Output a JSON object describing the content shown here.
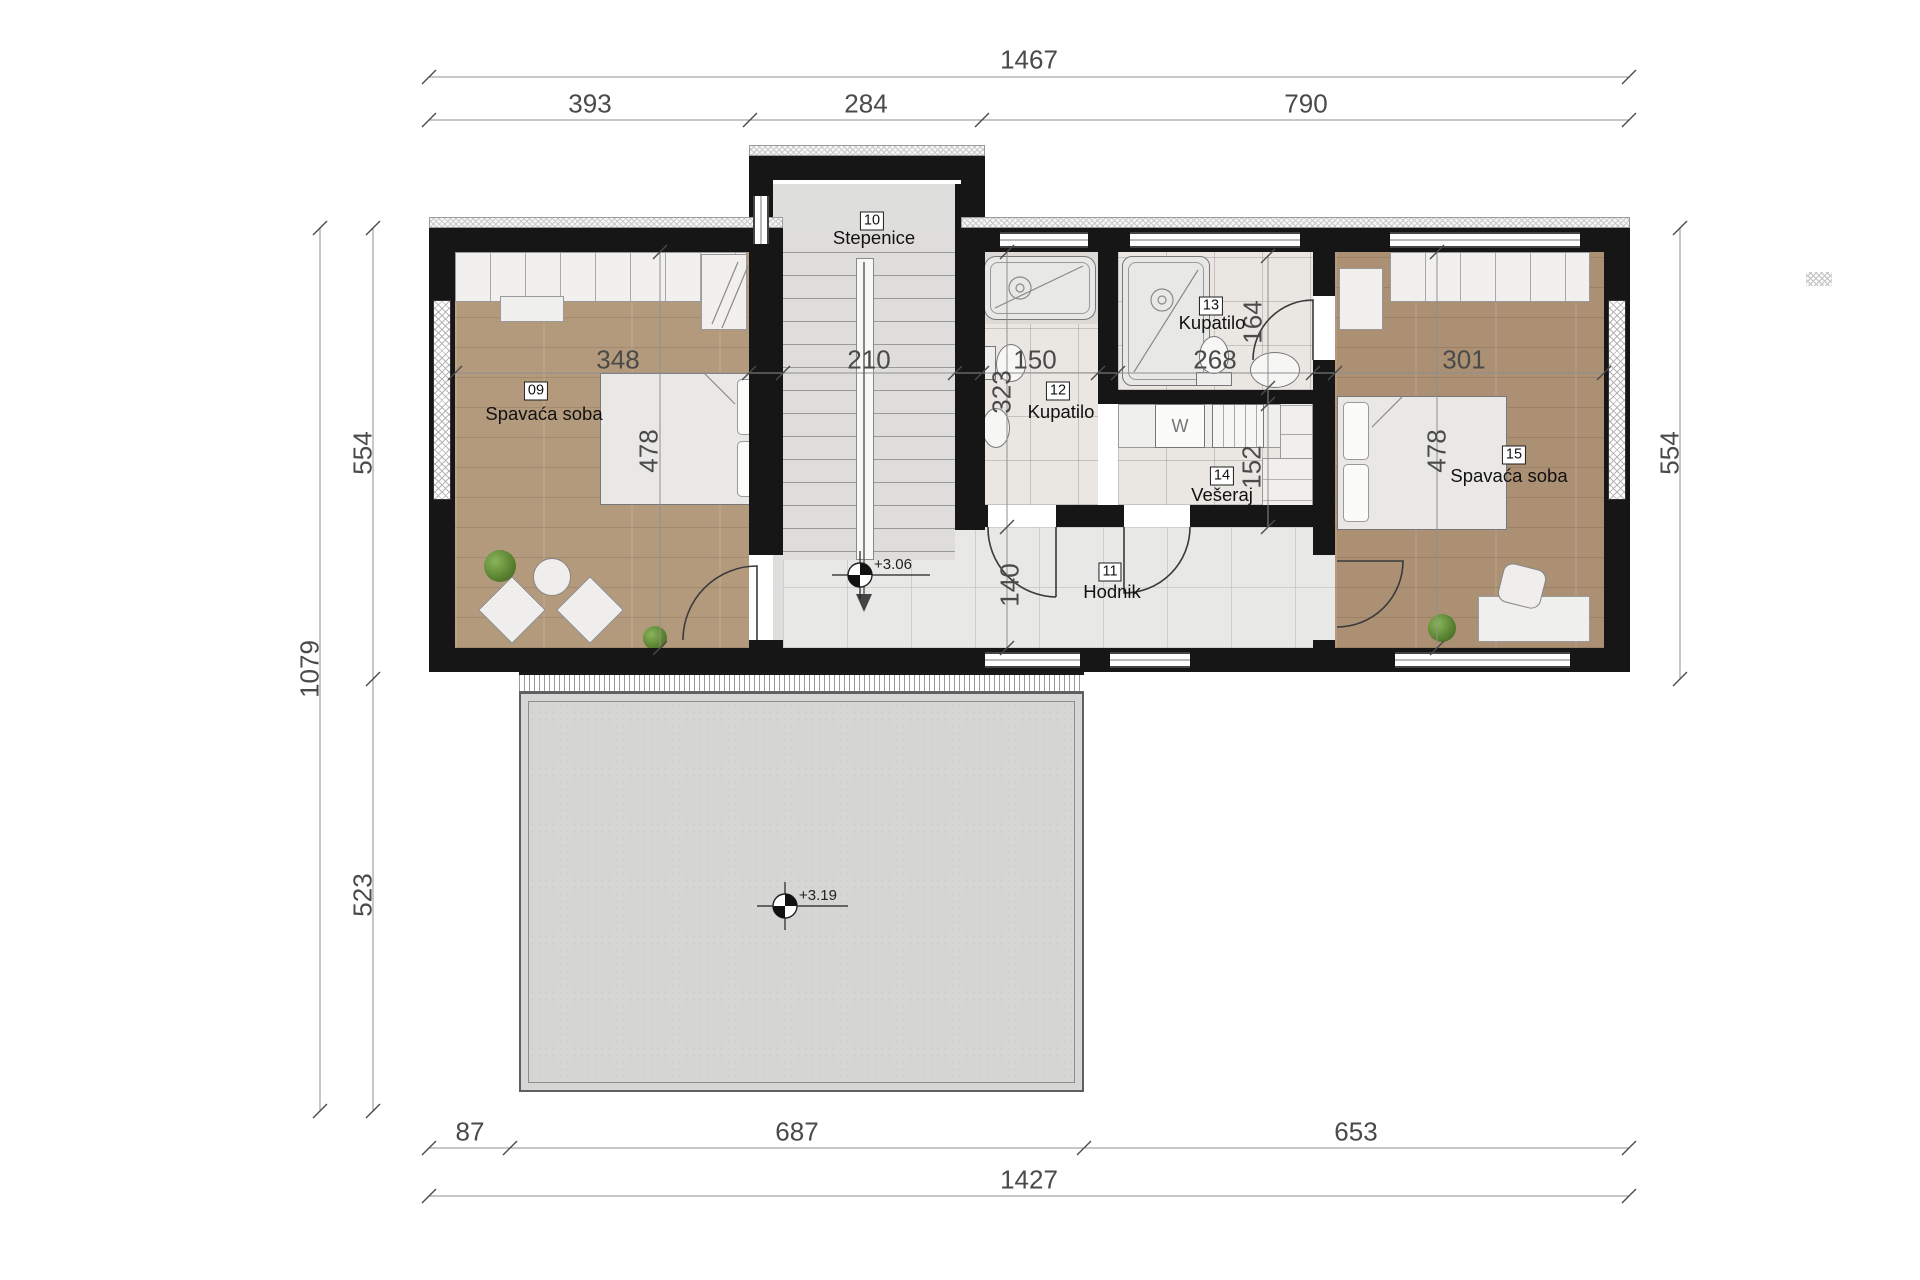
{
  "dims": {
    "top": {
      "total": "1467",
      "segs": [
        "393",
        "284",
        "790"
      ]
    },
    "bottom": {
      "segs": [
        "87",
        "687",
        "653"
      ],
      "total": "1427"
    },
    "left": {
      "total": "1079",
      "upper": "554",
      "lower": "523"
    },
    "right": {
      "upper": "554"
    },
    "inner": {
      "bed09_w": "348",
      "stairs_w": "210",
      "bath12_w": "150",
      "bath13_w": "268",
      "bed15_w": "301",
      "bed09_h": "478",
      "bed15_h": "478",
      "bath12_h": "323",
      "bath13_h": "164",
      "veseraj_h": "152",
      "hodnik_h": "140"
    }
  },
  "rooms": {
    "r09": {
      "num": "09",
      "name": "Spavaća soba"
    },
    "r10": {
      "num": "10",
      "name": "Stepenice"
    },
    "r11": {
      "num": "11",
      "name": "Hodnik"
    },
    "r12": {
      "num": "12",
      "name": "Kupatilo"
    },
    "r13": {
      "num": "13",
      "name": "Kupatilo"
    },
    "r14": {
      "num": "14",
      "name": "Vešeraj"
    },
    "r15": {
      "num": "15",
      "name": "Spavaća soba"
    }
  },
  "levels": {
    "upper": "+3.06",
    "terrace": "+3.19"
  },
  "appliances": {
    "washer": "W"
  },
  "colors": {
    "wall": "#161616",
    "dim_text": "#4a4a4a",
    "wood": "#b49a7d",
    "wood_dark": "#ab9074",
    "tile": "#eae7e3",
    "terrace": "#d6d6d4",
    "plant_green": "#567f2e"
  }
}
